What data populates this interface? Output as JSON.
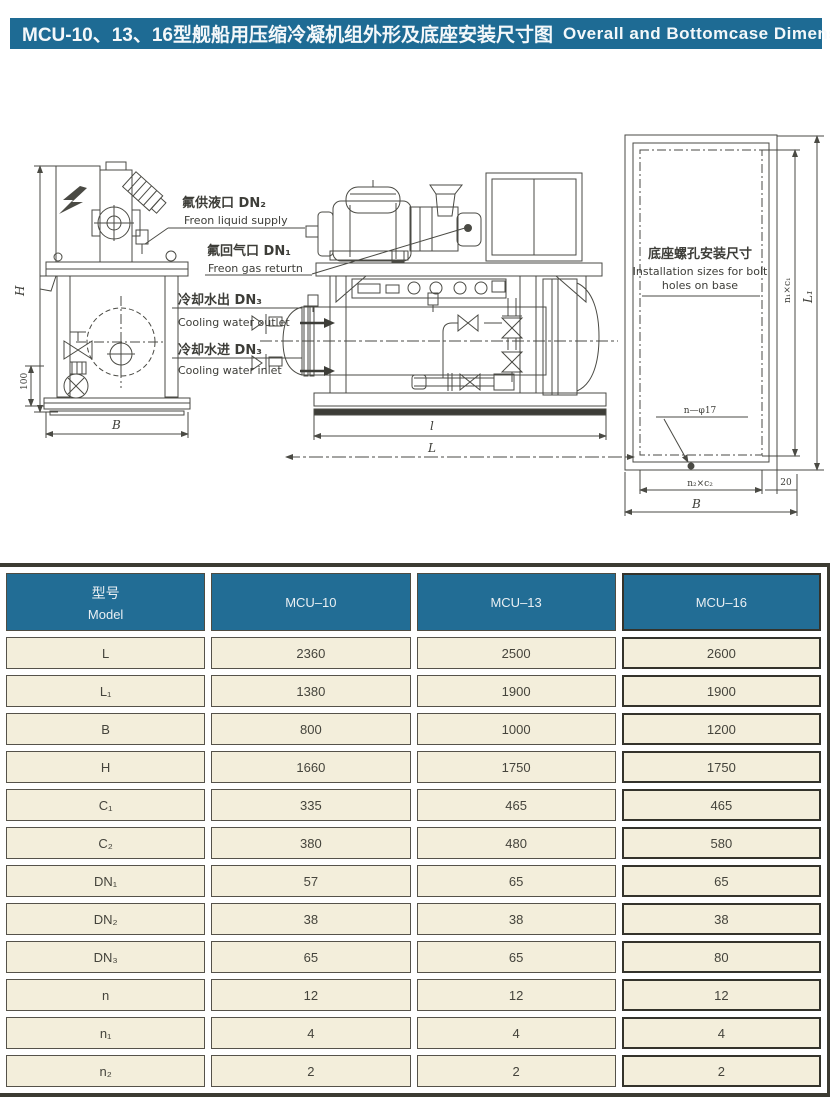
{
  "title": {
    "zh": "MCU-10、13、16型舰船用压缩冷凝机组外形及底座安装尺寸图",
    "en": "Overall and Bottomcase Dimension  Diagram"
  },
  "colors": {
    "title_bg": "#1e6b94",
    "table_header_bg": "#226d95",
    "table_cell_bg": "#f3eedb",
    "line": "#4a4a44"
  },
  "callouts": {
    "freon_liquid": {
      "zh": "氟供液口 DN₂",
      "en": "Freon liquid supply"
    },
    "freon_gas": {
      "zh": "氟回气口 DN₁",
      "en": "Freon gas returtn"
    },
    "water_outlet": {
      "zh": "冷却水出 DN₃",
      "en": "Cooling water outlet"
    },
    "water_inlet": {
      "zh": "冷却水进 DN₃",
      "en": "Cooling water inlet"
    }
  },
  "front_view": {
    "dim_h": "H",
    "dim_b": "B",
    "dim_100": "100"
  },
  "side_view": {
    "dim_inner": "l",
    "dim_outer": "L"
  },
  "base_plate": {
    "title_zh": "底座螺孔安装尺寸",
    "title_en1": "Installation sizes for bolt",
    "title_en2": "holes on base",
    "holes": "n—φ17",
    "dim_n2c2": "n₂×c₂",
    "dim_b": "B",
    "dim_20": "20",
    "dim_n1c1": "n₁×c₁",
    "dim_l1": "L₁"
  },
  "table": {
    "header": {
      "model_zh": "型号",
      "model_en": "Model",
      "cols": [
        "MCU–10",
        "MCU–13",
        "MCU–16"
      ]
    },
    "rows": [
      {
        "param": "L",
        "values": [
          "2360",
          "2500",
          "2600"
        ]
      },
      {
        "param": "L₁",
        "values": [
          "1380",
          "1900",
          "1900"
        ]
      },
      {
        "param": "B",
        "values": [
          "800",
          "1000",
          "1200"
        ]
      },
      {
        "param": "H",
        "values": [
          "1660",
          "1750",
          "1750"
        ]
      },
      {
        "param": "C₁",
        "values": [
          "335",
          "465",
          "465"
        ]
      },
      {
        "param": "C₂",
        "values": [
          "380",
          "480",
          "580"
        ]
      },
      {
        "param": "DN₁",
        "values": [
          "57",
          "65",
          "65"
        ]
      },
      {
        "param": "DN₂",
        "values": [
          "38",
          "38",
          "38"
        ]
      },
      {
        "param": "DN₃",
        "values": [
          "65",
          "65",
          "80"
        ]
      },
      {
        "param": "n",
        "values": [
          "12",
          "12",
          "12"
        ]
      },
      {
        "param": "n₁",
        "values": [
          "4",
          "4",
          "4"
        ]
      },
      {
        "param": "n₂",
        "values": [
          "2",
          "2",
          "2"
        ]
      }
    ]
  }
}
